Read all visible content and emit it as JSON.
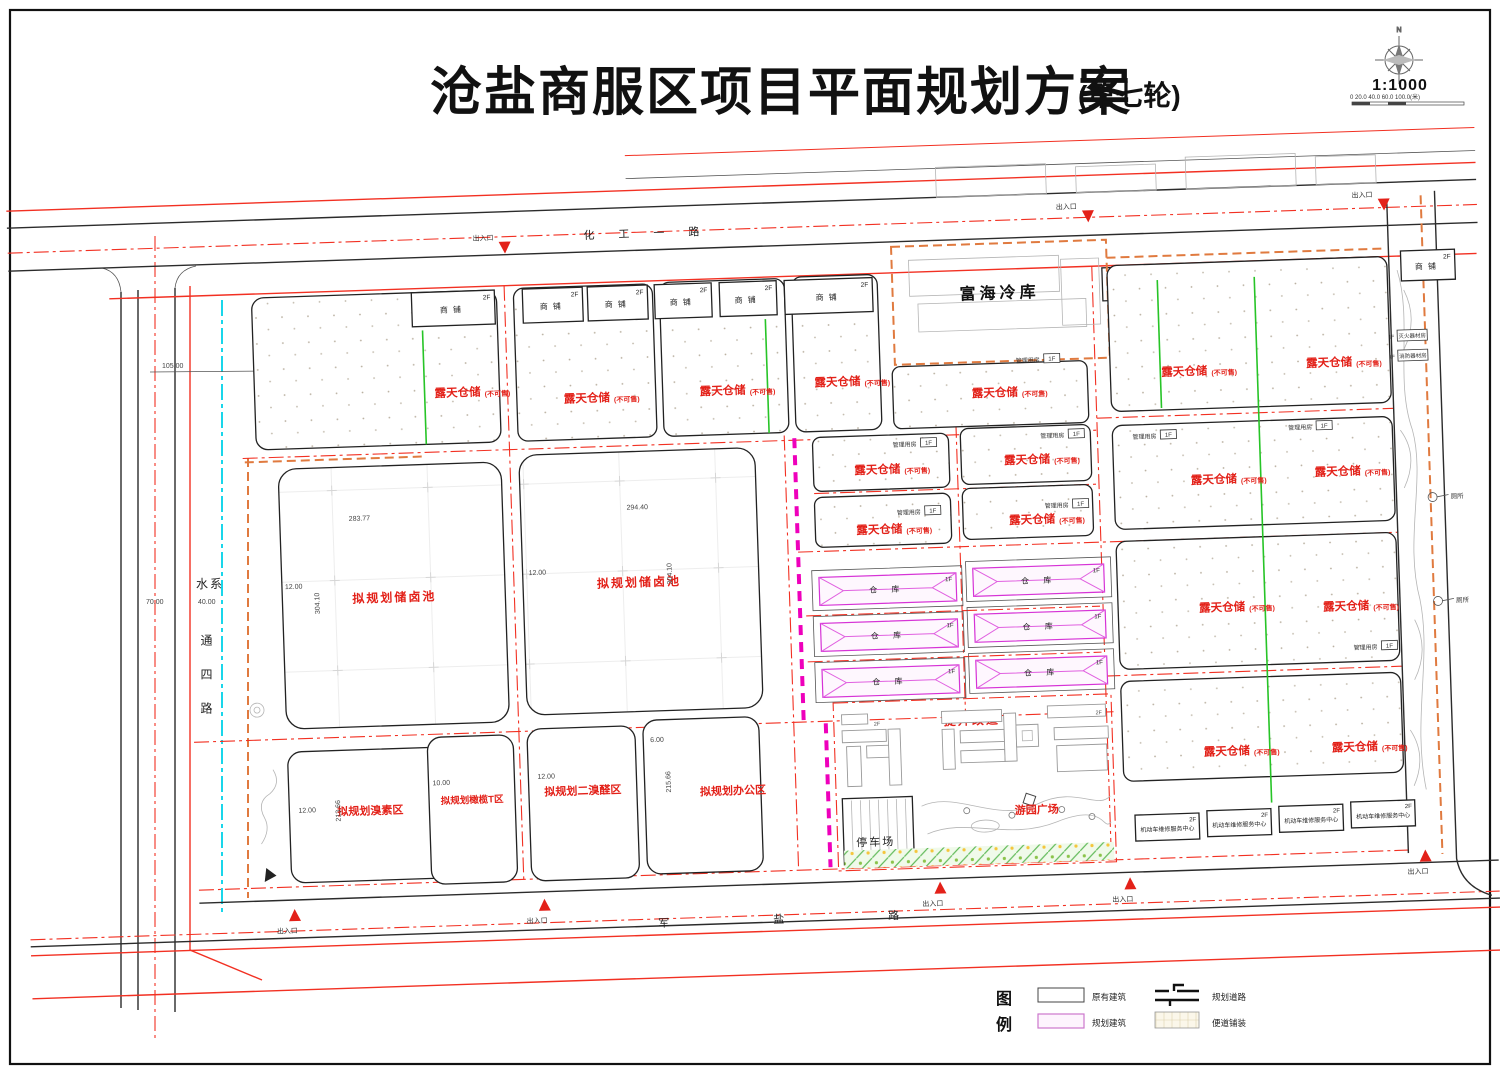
{
  "title": {
    "main": "沧盐商服区项目平面规划方案",
    "round": "(第七轮)"
  },
  "compass": {
    "north": "N",
    "scale": "1:1000",
    "ticks": "0   20.0   40.0   60.0   100.0(米)"
  },
  "roads": {
    "huagong": "化工一路",
    "junyan": "军盐路",
    "tongsi": "通四路",
    "water": "水系"
  },
  "labels": {
    "shop": "商铺",
    "f2": "2F",
    "f1": "1F",
    "warehouse": "仓 库",
    "open_storage": "露天仓储",
    "not_for_sale": "(不可售)",
    "brine_pool": "拟规划储卤池",
    "bromine_zone": "拟规划溴素区",
    "olive_zone": "拟规划橄榄T区",
    "dibromo_zone": "拟规划二溴醛区",
    "office_zone": "拟规划办公区",
    "cold_storage": "富海冷库",
    "management_room": "管理用房",
    "upgrade": "提升改造",
    "parking": "停车场",
    "garden_plaza": "游园广场",
    "vehicle_service": "机动车维修服务中心",
    "fire_equipment": "灭火器材房",
    "fire_service": "消防器材房",
    "toilet": "厕所",
    "entrance": "出入口"
  },
  "dims": {
    "d105": "105.00",
    "d182": "182.54",
    "d193": "193.44",
    "d70": "70.00",
    "d40": "40.00",
    "d283": "283.77",
    "d294": "294.40",
    "d304": "304.10",
    "d12": "12.00",
    "d10": "10.00",
    "d6": "6.00",
    "d213": "213.66",
    "d215": "215.66"
  },
  "legend": {
    "heading_top": "图",
    "heading_bottom": "例",
    "existing": "原有建筑",
    "planned": "规划建筑",
    "planned_road": "规划道路",
    "pavement": "便道铺装"
  }
}
